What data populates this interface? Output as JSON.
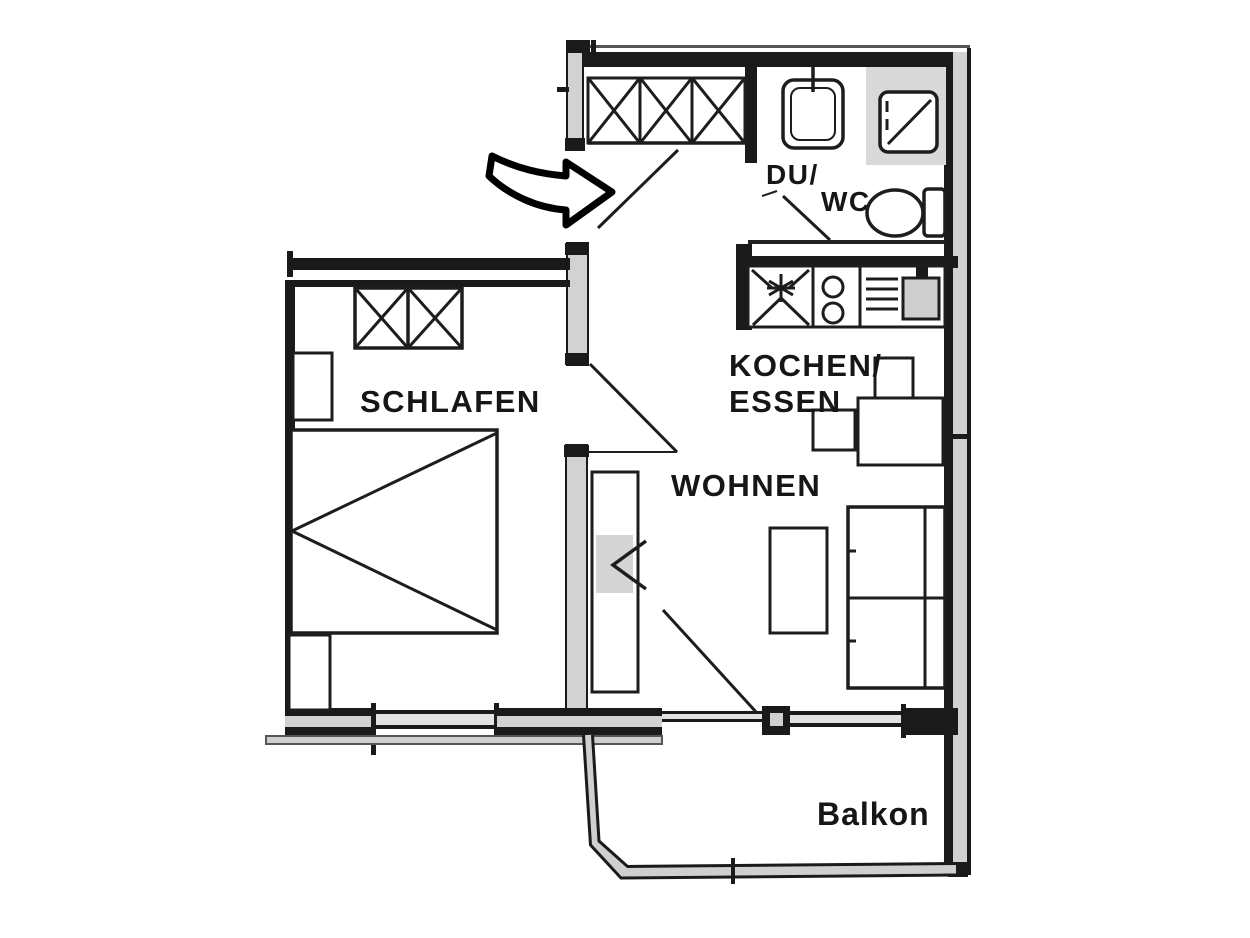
{
  "page": {
    "background": "#ffffff",
    "description": "Architectural floor plan of a one-bedroom apartment with balcony"
  },
  "floor_plan": {
    "type": "apartment-floor-plan",
    "rooms": {
      "schlafen": {
        "label": "SCHLAFEN"
      },
      "wohnen": {
        "label": "WOHNEN"
      },
      "kochen_essen": {
        "line1": "KOCHEN/",
        "line2": "ESSEN"
      },
      "du_wc": {
        "line1": "DU/",
        "line2": "WC"
      },
      "balkon": {
        "label": "Balkon"
      }
    },
    "fixtures": [
      "entrance-arrow",
      "hall-wardrobe",
      "bedroom-wardrobe",
      "bed",
      "nightstand-top",
      "nightstand-bottom",
      "shelf-unit",
      "coffee-table",
      "sofa",
      "dining-table",
      "dining-chairs",
      "kitchen-counter",
      "refrigerator-symbol",
      "cooktop-burners",
      "vent-grille",
      "kitchen-sink",
      "bathroom-sink",
      "shower",
      "toilet",
      "balcony-railing",
      "entrance-door",
      "bathroom-door",
      "bedroom-door",
      "balcony-door"
    ],
    "colors": {
      "wall": "#1a1a1a",
      "wall_fill": "#d2d2d2",
      "fixture_line": "#1d1d1d",
      "shading": "#d9d9d9",
      "background": "#ffffff"
    }
  }
}
